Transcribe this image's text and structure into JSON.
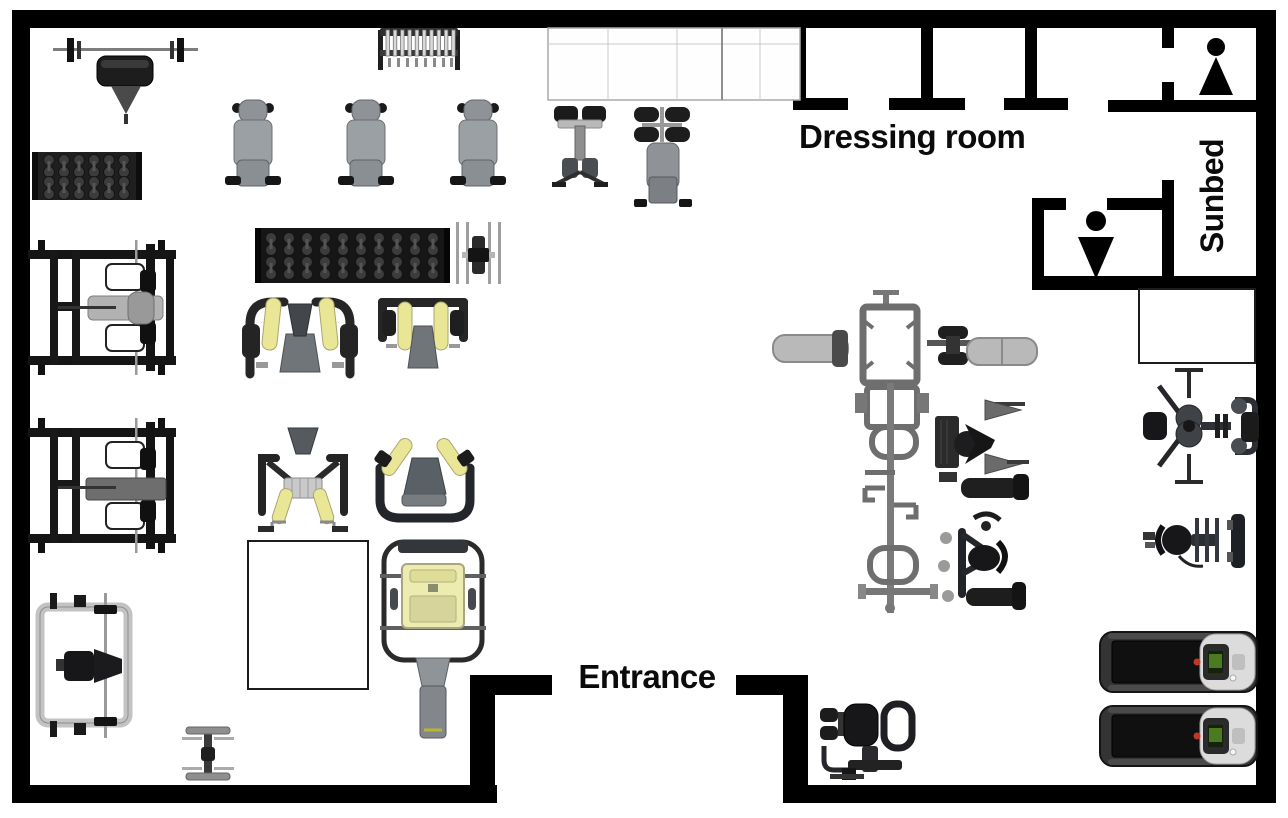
{
  "page": {
    "title": "Gym floor plan"
  },
  "labels": {
    "dressing_room": "Dressing room",
    "sunbed": "Sunbed",
    "entrance": "Entrance"
  },
  "rooms": [
    {
      "name": "dressing-room",
      "label": "Dressing room"
    },
    {
      "name": "women-restroom",
      "icon": "woman-icon"
    },
    {
      "name": "men-restroom",
      "icon": "man-icon"
    },
    {
      "name": "sunbed-room",
      "label": "Sunbed"
    },
    {
      "name": "entrance-vestibule",
      "label": "Entrance"
    }
  ],
  "icons": [
    {
      "name": "woman-icon",
      "shape": "circle-head-over-up-triangle"
    },
    {
      "name": "man-icon",
      "shape": "circle-head-over-down-triangle"
    }
  ],
  "colors": {
    "wall": "#000000",
    "floor": "#ffffff",
    "accent_yellow": "#e9e795",
    "equipment_dark": "#1d1d1d",
    "equipment_gray": "#8f9397",
    "equipment_light": "#c3c3c3",
    "treadmill_screen_green": "#4c7a22",
    "treadmill_dot_red": "#c23527"
  },
  "equipment": [
    "bench-press",
    "barbell-rack",
    "dumbbell-rack-small",
    "adjustable-bench",
    "roman-chair",
    "ab-bench",
    "dumbbell-rack-long",
    "arm-machine",
    "power-rack",
    "pec-fly-machine",
    "shoulder-press-machine",
    "seated-row-machine",
    "dip-shrug-machine",
    "hack-squat-machine",
    "smith-machine",
    "flat-bench",
    "functional-trainer",
    "cable-column-machine",
    "exercise-bike-machine",
    "pec-deck-machine",
    "leg-curl-machine",
    "treadmill",
    "glute-kickback-machine",
    "mat-area"
  ]
}
